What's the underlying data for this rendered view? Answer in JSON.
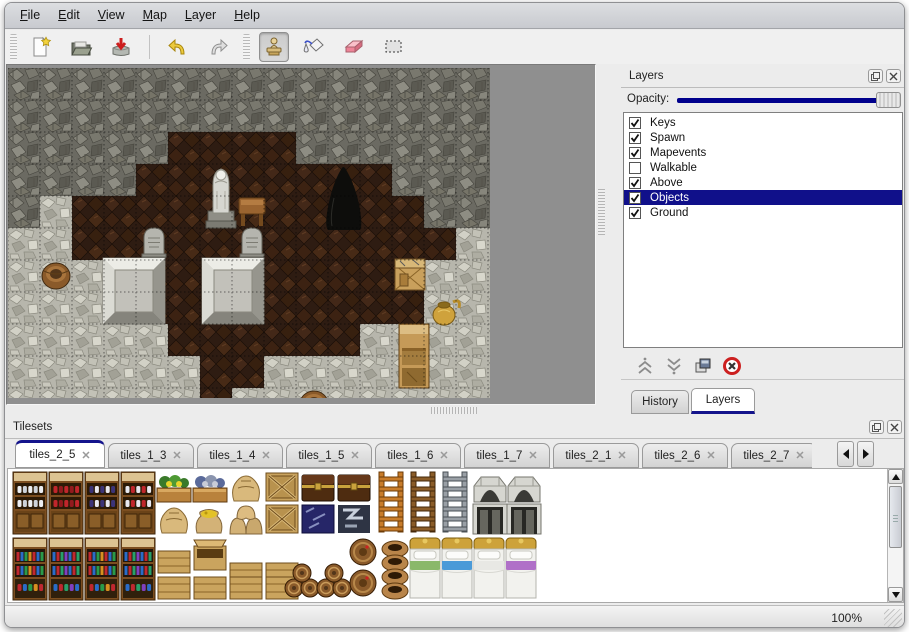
{
  "colors": {
    "selection_navy": "#10108a",
    "slider_track": "#00008c",
    "tab_accent": "#14148c"
  },
  "menu": {
    "items": [
      "File",
      "Edit",
      "View",
      "Map",
      "Layer",
      "Help"
    ]
  },
  "toolbar": {
    "groups": [
      [
        "new-file",
        "open",
        "save"
      ],
      [
        "undo",
        "redo"
      ],
      [
        "stamp",
        "fill",
        "eraser",
        "select-rect"
      ]
    ],
    "active_tool": "stamp"
  },
  "layers_panel": {
    "title": "Layers",
    "opacity_label": "Opacity:",
    "opacity_fraction": 1.0,
    "items": [
      {
        "label": "Keys",
        "checked": true,
        "selected": false
      },
      {
        "label": "Spawn",
        "checked": true,
        "selected": false
      },
      {
        "label": "Mapevents",
        "checked": true,
        "selected": false
      },
      {
        "label": "Walkable",
        "checked": false,
        "selected": false
      },
      {
        "label": "Above",
        "checked": true,
        "selected": false
      },
      {
        "label": "Objects",
        "checked": true,
        "selected": true
      },
      {
        "label": "Ground",
        "checked": true,
        "selected": false
      }
    ],
    "buttons": [
      "raise-layer",
      "lower-layer",
      "duplicate-layer",
      "delete-layer"
    ],
    "tabs": [
      {
        "label": "History",
        "active": false
      },
      {
        "label": "Layers",
        "active": true
      }
    ]
  },
  "tilesets_panel": {
    "title": "Tilesets",
    "tabs": [
      {
        "label": "tiles_2_5",
        "active": true
      },
      {
        "label": "tiles_1_3",
        "active": false
      },
      {
        "label": "tiles_1_4",
        "active": false
      },
      {
        "label": "tiles_1_5",
        "active": false
      },
      {
        "label": "tiles_1_6",
        "active": false
      },
      {
        "label": "tiles_1_7",
        "active": false
      },
      {
        "label": "tiles_2_1",
        "active": false
      },
      {
        "label": "tiles_2_6",
        "active": false
      },
      {
        "label": "tiles_2_7",
        "active": false
      },
      {
        "label": "tiles_",
        "active": false,
        "truncated": true
      }
    ],
    "palette": [
      {
        "t": "shelf_dishes",
        "x": 3,
        "y": 2
      },
      {
        "t": "shelf_red",
        "x": 39,
        "y": 2
      },
      {
        "t": "shelf_purple",
        "x": 75,
        "y": 2
      },
      {
        "t": "shelf_jars",
        "x": 111,
        "y": 2
      },
      {
        "t": "veg_yellow",
        "x": 147,
        "y": 2
      },
      {
        "t": "veg_blue",
        "x": 183,
        "y": 2
      },
      {
        "t": "sack",
        "x": 219,
        "y": 2
      },
      {
        "t": "crate_x",
        "x": 255,
        "y": 2
      },
      {
        "t": "chest_dark",
        "x": 291,
        "y": 2
      },
      {
        "t": "chest_dark",
        "x": 327,
        "y": 2
      },
      {
        "t": "sack",
        "x": 147,
        "y": 34
      },
      {
        "t": "sack_open",
        "x": 183,
        "y": 34
      },
      {
        "t": "sack_stack",
        "x": 219,
        "y": 34
      },
      {
        "t": "crate_x",
        "x": 255,
        "y": 34
      },
      {
        "t": "crate_blue",
        "x": 291,
        "y": 34
      },
      {
        "t": "metal",
        "x": 327,
        "y": 34
      },
      {
        "t": "ladder_orange",
        "x": 365,
        "y": 2
      },
      {
        "t": "ladder_brown",
        "x": 397,
        "y": 2
      },
      {
        "t": "ladder_gray",
        "x": 429,
        "y": 2
      },
      {
        "t": "arch_top",
        "x": 463,
        "y": 2
      },
      {
        "t": "arch_top",
        "x": 497,
        "y": 2
      },
      {
        "t": "arch_door",
        "x": 463,
        "y": 34
      },
      {
        "t": "arch_door",
        "x": 497,
        "y": 34
      },
      {
        "t": "shelf_books",
        "x": 3,
        "y": 68
      },
      {
        "t": "shelf_books2",
        "x": 39,
        "y": 68
      },
      {
        "t": "shelf_books",
        "x": 75,
        "y": 68
      },
      {
        "t": "shelf_books2",
        "x": 111,
        "y": 68
      },
      {
        "t": "crate",
        "x": 147,
        "y": 80
      },
      {
        "t": "crate_open",
        "x": 183,
        "y": 68
      },
      {
        "t": "crate",
        "x": 219,
        "y": 92
      },
      {
        "t": "crate",
        "x": 255,
        "y": 92
      },
      {
        "t": "crate",
        "x": 147,
        "y": 106
      },
      {
        "t": "crate",
        "x": 183,
        "y": 106
      },
      {
        "t": "crate",
        "x": 219,
        "y": 106
      },
      {
        "t": "crate",
        "x": 255,
        "y": 106
      },
      {
        "t": "barrel_pile",
        "x": 275,
        "y": 74
      },
      {
        "t": "barrel_pile",
        "x": 307,
        "y": 74
      },
      {
        "t": "barrel_front",
        "x": 339,
        "y": 68
      },
      {
        "t": "pots",
        "x": 371,
        "y": 68
      },
      {
        "t": "bed_green",
        "x": 399,
        "y": 68
      },
      {
        "t": "bed_blue",
        "x": 431,
        "y": 68
      },
      {
        "t": "bed_white",
        "x": 463,
        "y": 68
      },
      {
        "t": "bed_purple",
        "x": 495,
        "y": 68
      }
    ]
  },
  "map": {
    "tile_size": 32,
    "tilemap": [
      "WWWWWWWWWWWWWWW",
      "WWWWWWWWWWWWWWW",
      "WWWWWFFFFWWWWWW",
      "WWWWFFFFFFFFWWW",
      "WRFFFFFFFFFFFWW",
      "RRFFFFFFFFFFFFR",
      "RRRFFFFFFFFFFRR",
      "RRRRFFFFFFFFFRR",
      "RRRRRFFFFFFRRRR",
      "RRRRRRFFRRRRRRR",
      "RRRRRRFRRRRRRRR"
    ],
    "objects": [
      {
        "t": "tomb",
        "x": 95,
        "y": 190
      },
      {
        "t": "tomb",
        "x": 194,
        "y": 190
      },
      {
        "t": "grave",
        "x": 134,
        "y": 158
      },
      {
        "t": "grave",
        "x": 232,
        "y": 158
      },
      {
        "t": "statue",
        "x": 198,
        "y": 95
      },
      {
        "t": "table",
        "x": 231,
        "y": 130
      },
      {
        "t": "cave",
        "x": 318,
        "y": 96
      },
      {
        "t": "crate",
        "x": 386,
        "y": 190
      },
      {
        "t": "shelf",
        "x": 391,
        "y": 256
      },
      {
        "t": "jug",
        "x": 424,
        "y": 228
      },
      {
        "t": "barrel",
        "x": 292,
        "y": 322
      },
      {
        "t": "barrel",
        "x": 34,
        "y": 194
      }
    ]
  },
  "statusbar": {
    "zoom_level": "100%"
  }
}
